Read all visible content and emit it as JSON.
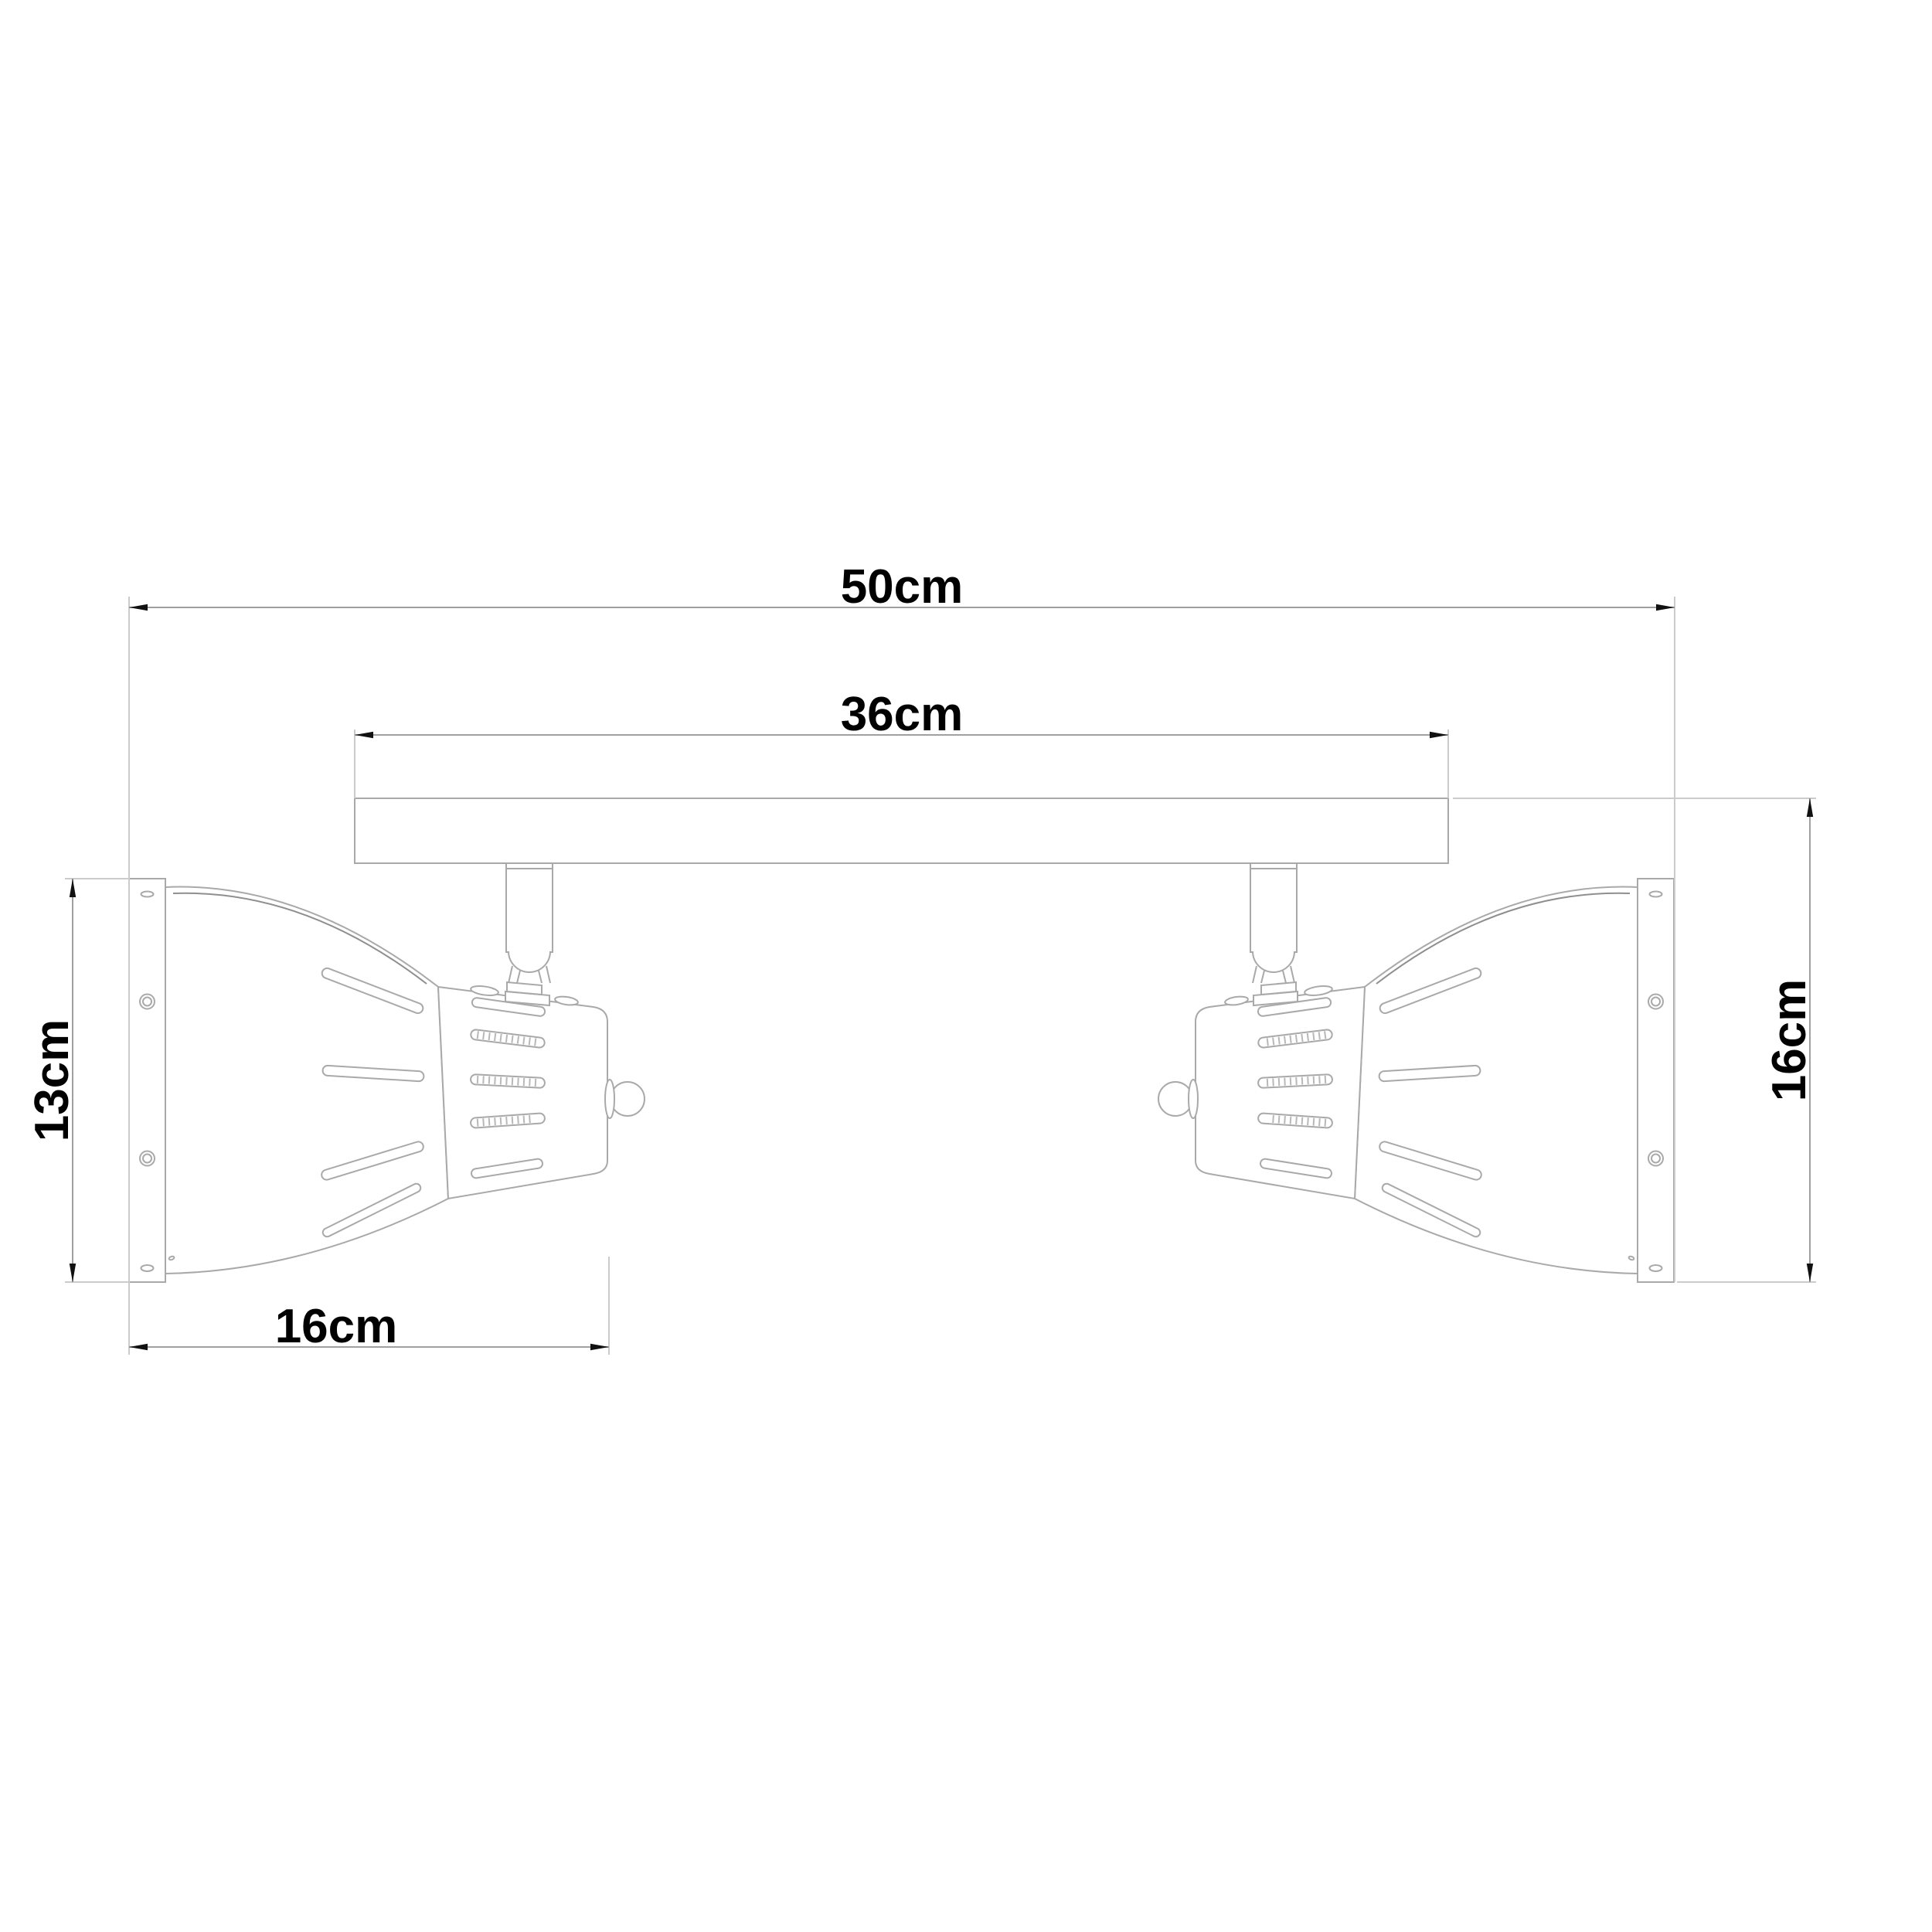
{
  "drawing": {
    "type": "product dimension diagram",
    "product": "two-head ceiling spotlight bar",
    "labels": {
      "overall_width": "50cm",
      "bar_width": "36cm",
      "shade_height": "13cm",
      "head_depth": "16cm",
      "fixture_height": "16cm"
    },
    "colors": {
      "background": "#ffffff",
      "geometry_line": "#a9a9a9",
      "rim_line": "#8f8f8f",
      "dimension_line": "#a0a0a0",
      "extension_line": "#cbcbcb",
      "text_and_arrows": "#000000"
    }
  }
}
